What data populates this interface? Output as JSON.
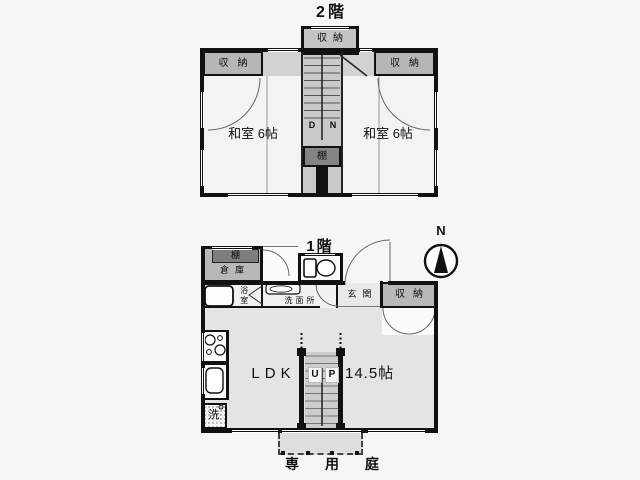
{
  "floor2": {
    "title": "2階",
    "closet_top": "収納",
    "closet_left": "収納",
    "closet_right": "収納",
    "room_left_name": "和室",
    "room_left_size": "6帖",
    "room_right_name": "和室",
    "room_right_size": "6帖",
    "stair_d": "D",
    "stair_n": "N",
    "shelf": "棚"
  },
  "floor1": {
    "title": "1階",
    "compass": "N",
    "storage_shelf": "棚",
    "storage": "倉庫",
    "bath": "浴室",
    "washroom": "洗面所",
    "entrance": "玄関",
    "closet": "収納",
    "ldk": "LDK",
    "up_u": "U",
    "up_p": "P",
    "ldk_size": "14.5帖",
    "washer": "洗",
    "garden": "専用庭"
  },
  "colors": {
    "wall": "#111111",
    "room_light": "#f3f3f3",
    "corridor": "#d2d2d2",
    "closet_gray": "#b6b6b6",
    "shelf_dark": "#848484",
    "ldk": "#e4e4e4",
    "stairs": "#c9c9c9",
    "terrace": "#dedede"
  }
}
